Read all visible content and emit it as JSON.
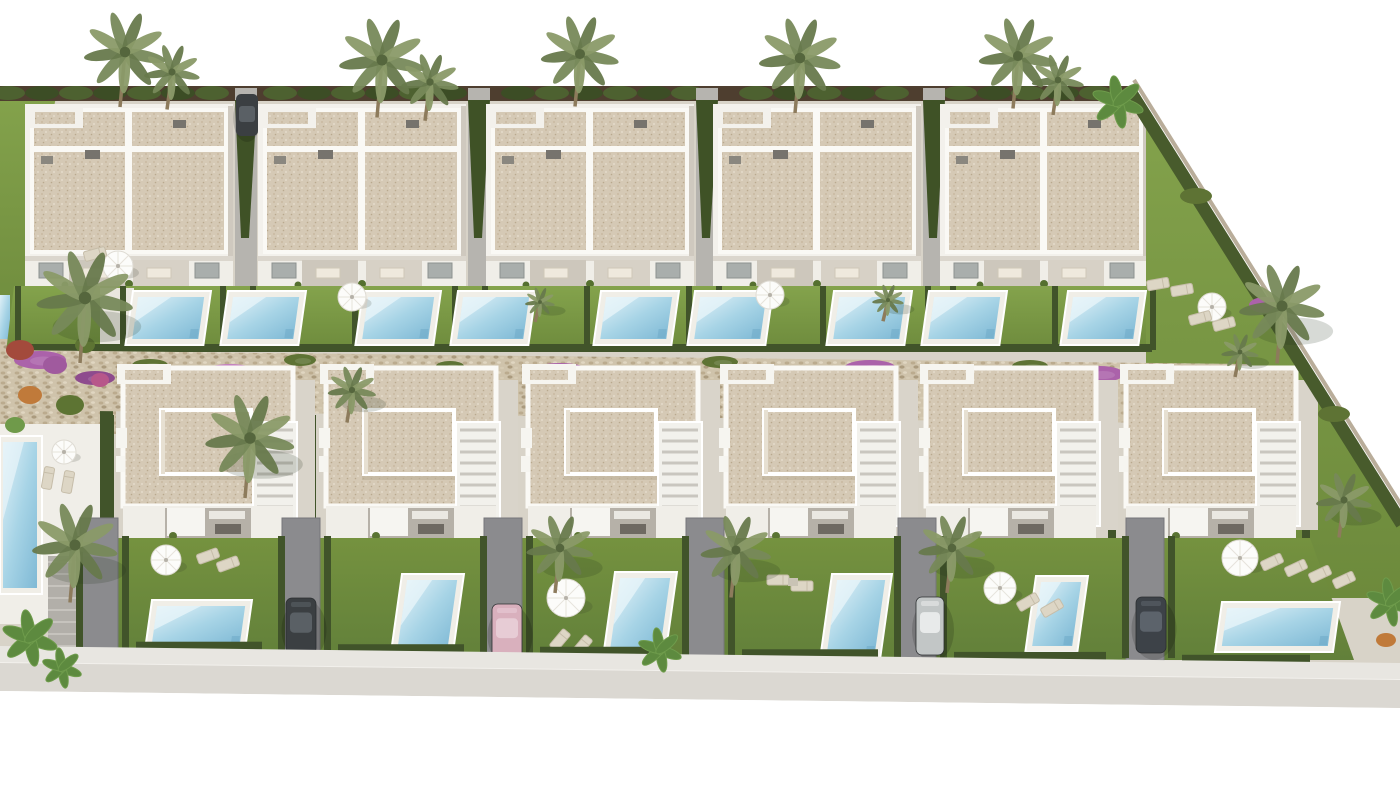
{
  "image": {
    "type": "3d architectural render",
    "view": "aerial birds-eye view",
    "subject": "new-build residential development of white Mediterranean villas with private pools",
    "setting": "two rows of villas separated by a landscaped stone walkway with bougainvillea; street along the bottom edge; white background beyond the plot"
  },
  "development": {
    "top_row": {
      "buildings": 5,
      "building_type": "single-storey semi-detached duplexes",
      "roof": "flat beige gravel roofs with white parapets and small roof vents",
      "private_pools_visible": 9,
      "parked_cars_visible": 1,
      "features": [
        "covered front terraces with dining sets",
        "lawned gardens divided by hedges",
        "sun umbrellas and loungers",
        "side driveways between buildings",
        "corner plot with large lawn"
      ]
    },
    "bottom_row": {
      "villas": 6,
      "villa_type": "two-storey detached villas",
      "private_pools_visible": 6,
      "parked_cars_visible": 4,
      "features": [
        "roof solarium",
        "external white staircase",
        "covered outdoor kitchen terrace",
        "front lawn with private pool",
        "side driveway",
        "dark timber street walls with white gate pillars"
      ]
    },
    "shared_landscaping": {
      "communal_pool_on_left_edge": true,
      "stone_walkway_with_bougainvillea": true,
      "palm_trees_approx": 20,
      "banana_plants_approx": 5,
      "sun_umbrellas_approx": 9,
      "colorful_shrubs": [
        "purple bougainvillea",
        "red",
        "orange",
        "green"
      ]
    },
    "street": {
      "location": "bottom edge",
      "elements": [
        "sidewalk",
        "curb",
        "asphalt road"
      ]
    }
  },
  "palette": {
    "background": "#ffffff",
    "lawn": "#80a048",
    "lawn_dark": "#6b883c",
    "hedge": "#41542a",
    "roof_beige": "#d5c9b5",
    "roof_speckle": "#c2b299",
    "wall_white": "#f3f1ec",
    "wall_shadow": "#d9d4cb",
    "pool_water": "#8ec4dc",
    "pool_water_light": "#dff0f7",
    "pool_coping": "#f0eee7",
    "stone_path": "#cfc3ab",
    "bougainvillea": "#ab62aa",
    "bougainvillea_light": "#c47fc0",
    "road": "#dbd8d2",
    "sidewalk": "#e8e6e1",
    "timber_dark": "#4e3e2f",
    "driveway": "#8b8b8e",
    "palm_frond": "#75875a",
    "palm_trunk": "#8d7b5c",
    "car_dark": "#3b3f42",
    "car_silver": "#c2c6c6",
    "car_pink": "#d9b0bd"
  }
}
